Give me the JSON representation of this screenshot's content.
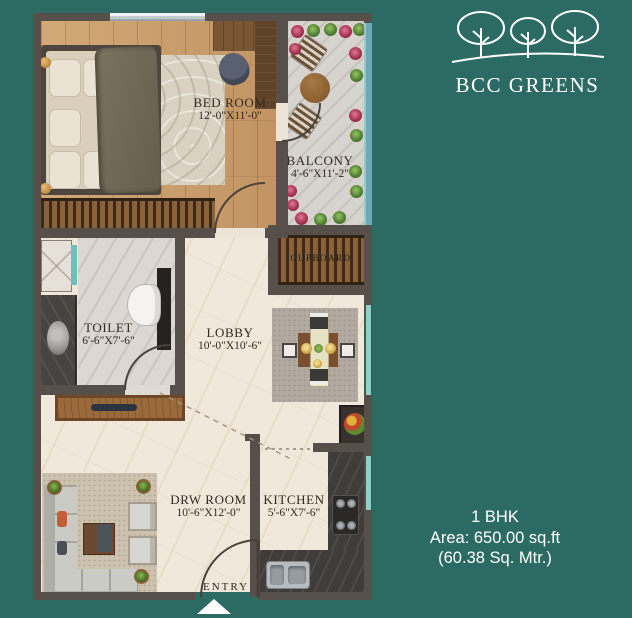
{
  "logo": {
    "brand": "BCC GREENS"
  },
  "unit": {
    "type": "1 BHK",
    "area": "Area: 650.00 sq.ft",
    "area_alt": "(60.38 Sq. Mtr.)"
  },
  "rooms": {
    "bedroom": {
      "label": "BED ROOM",
      "dims": "12'-0\"X11'-0\""
    },
    "balcony": {
      "label": "BALCONY",
      "dims": "4'-6\"X11'-2\""
    },
    "cupboard": {
      "label": "CUPBOARD"
    },
    "toilet": {
      "label": "TOILET",
      "dims": "6'-6\"X7'-6\""
    },
    "lobby": {
      "label": "LOBBY",
      "dims": "10'-0\"X10'-6\""
    },
    "drw_room": {
      "label": "DRW ROOM",
      "dims": "10'-6\"X12'-0\""
    },
    "kitchen": {
      "label": "KITCHEN",
      "dims": "5'-6\"X7'-6\""
    },
    "entry": {
      "label": "ENTRY"
    }
  },
  "colors": {
    "background": "#2c6b64",
    "wall": "#57504a",
    "wood_floor": "#c89f6b",
    "marble": "#f0e8da",
    "window_accent": "#8fd0cb",
    "label_text": "#33291f",
    "brand_text": "#ffffff"
  }
}
